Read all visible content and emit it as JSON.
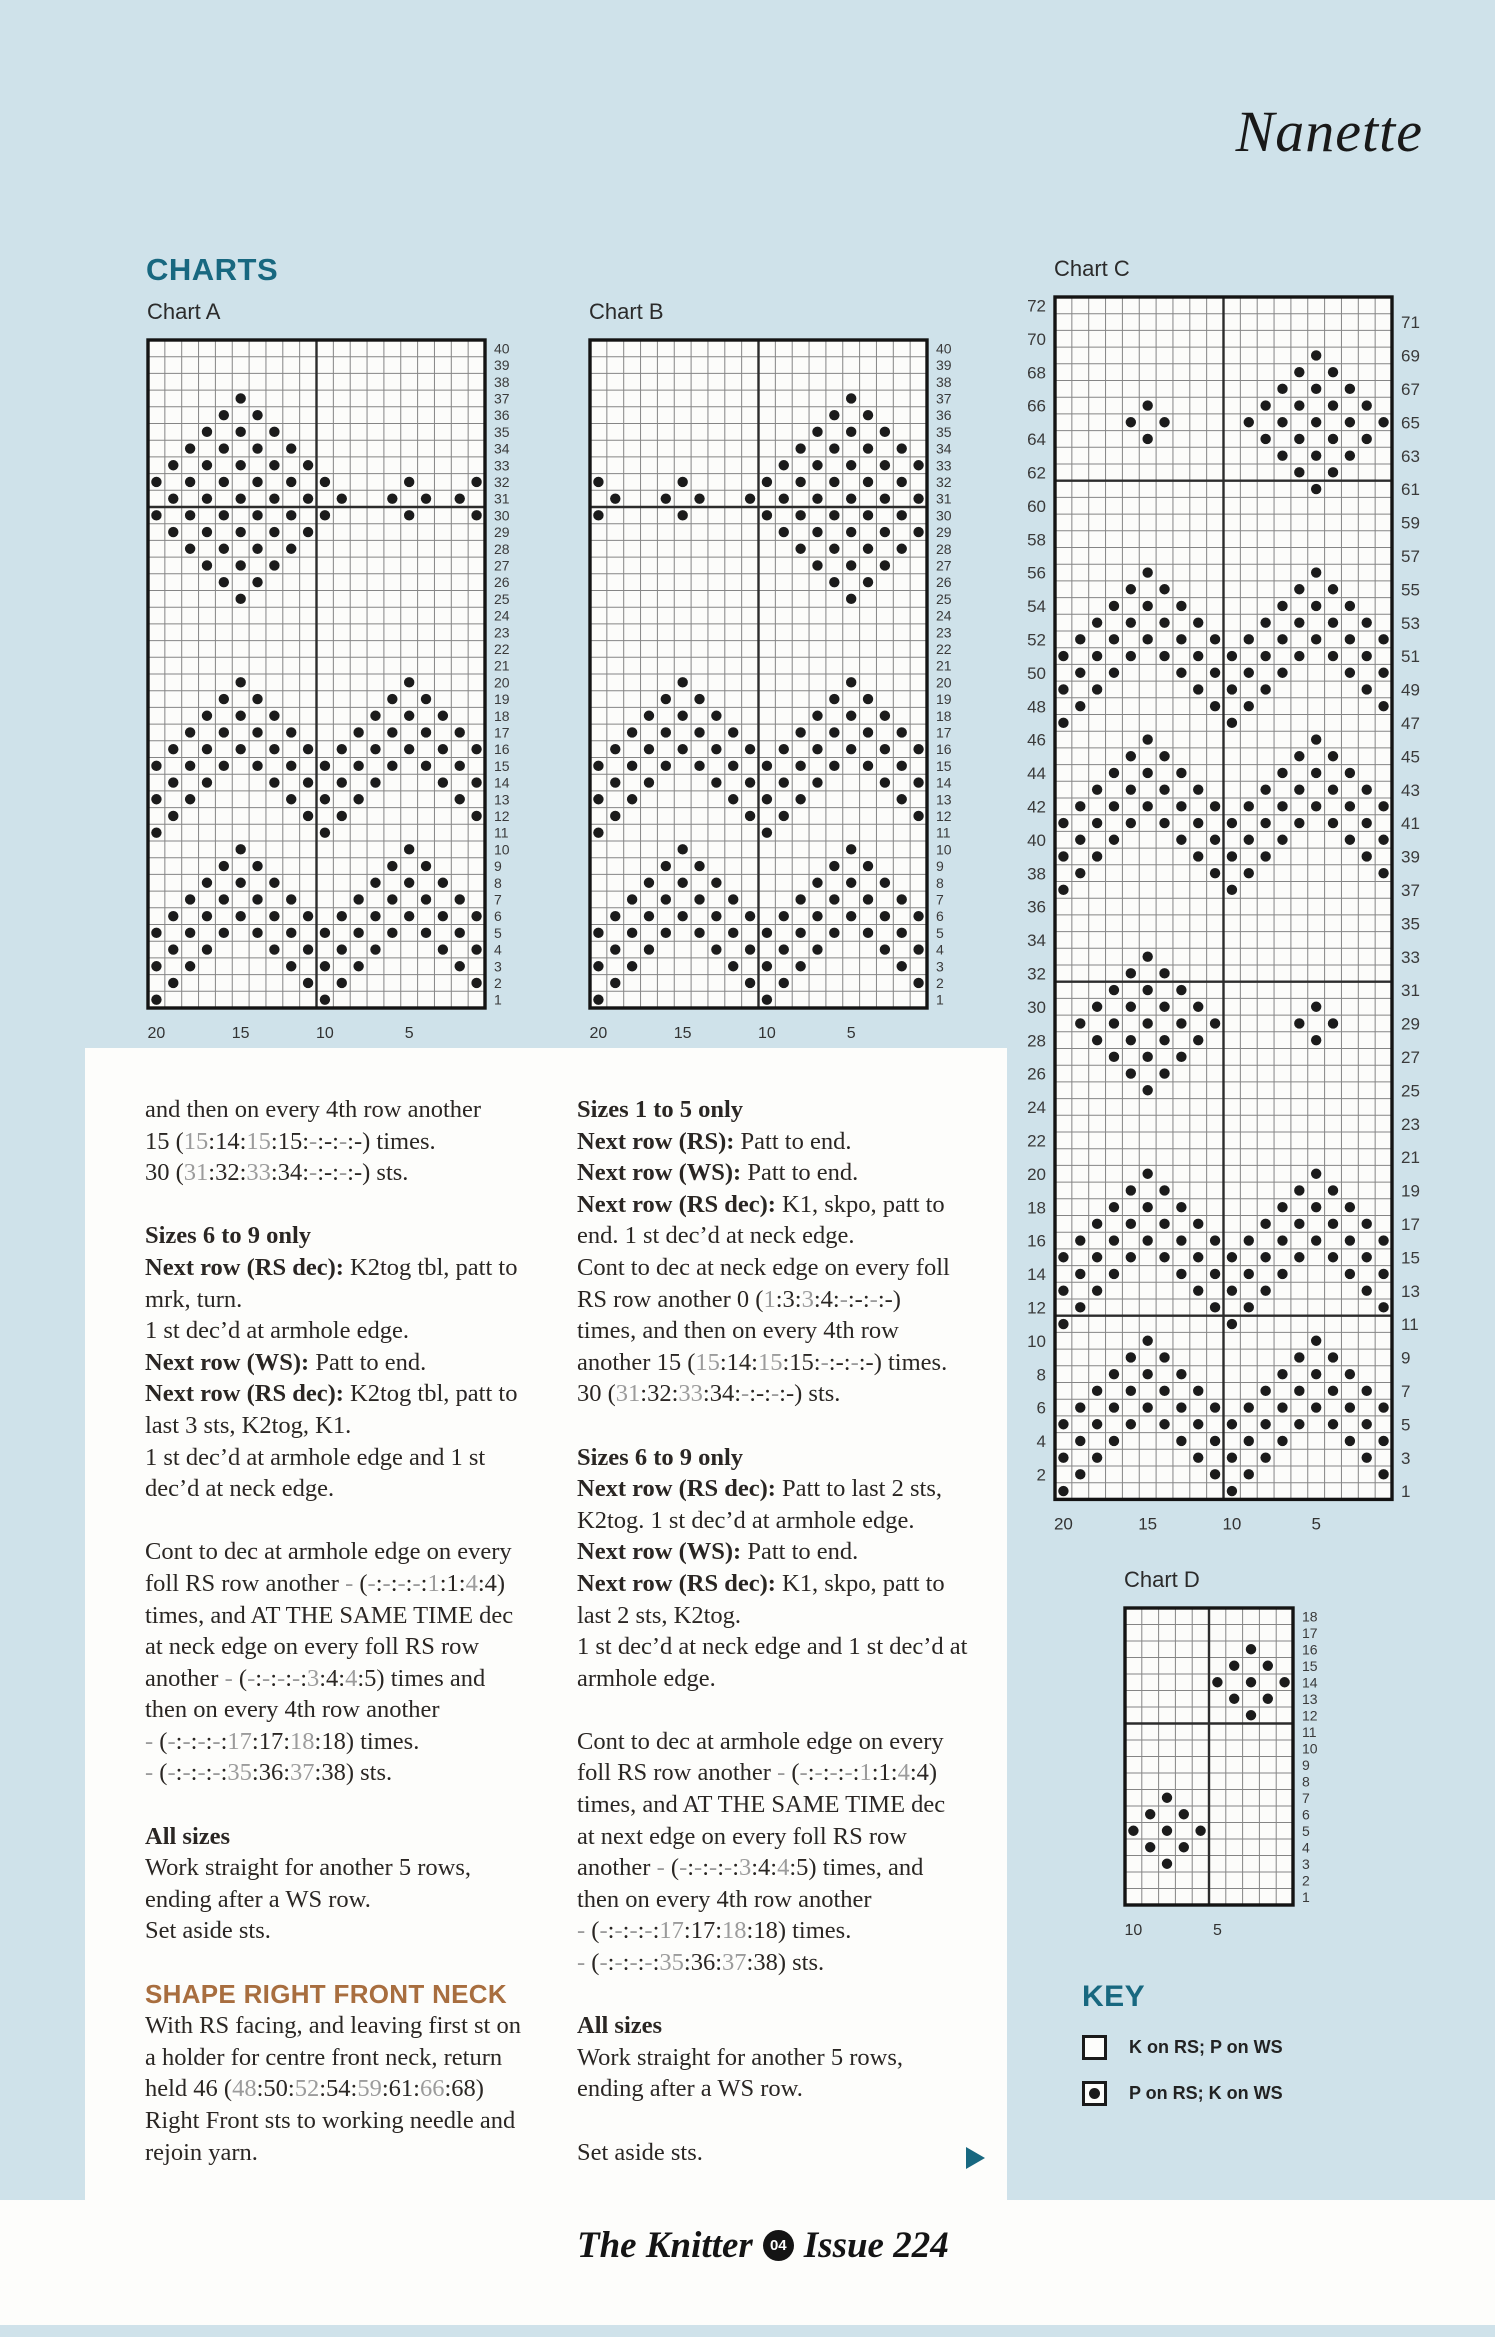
{
  "page": {
    "title": "Nanette",
    "background": "#cfe2ea",
    "accent_teal": "#186880",
    "accent_orange": "#a86e3f",
    "footer": {
      "magazine": "The Knitter",
      "badge": "04",
      "issue": "Issue 224"
    }
  },
  "charts_heading": "CHARTS",
  "key": {
    "heading": "KEY",
    "items": [
      {
        "symbol": "empty-square",
        "label": "K on RS; P on WS"
      },
      {
        "symbol": "dot-square",
        "label": "P on RS; K on WS"
      }
    ]
  },
  "charts": [
    {
      "id": "a",
      "label": "Chart A",
      "cols": 20,
      "rows": 40,
      "cw": 16.85,
      "ch": 16.7,
      "left": 148,
      "top": 340,
      "padl": 6,
      "row_label_mode": "right-all",
      "row_label_size": 14,
      "bottom_label_size": 16,
      "bottom_labels": [
        [
          "20",
          1
        ],
        [
          "15",
          6
        ],
        [
          "10",
          11
        ],
        [
          "5",
          16
        ]
      ],
      "bold_cols": [
        10
      ],
      "bold_rows": [
        10
      ],
      "grid": [
        "....................",
        "....................",
        "....................",
        ".....o..............",
        "....o.o.............",
        "...o.o.o............",
        "..o.o.o.o...........",
        ".o.o.o.o.o..........",
        "o.o.o.o.o.o....o...o",
        ".o.o.o.o.o.o..o.o.o.",
        "o.o.o.o.o.o....o...o",
        ".o.o.o.o.o..........",
        "..o.o.o.o...........",
        "...o.o.o............",
        "....o.o.............",
        ".....o..............",
        "....................",
        "....................",
        "....................",
        "....................",
        ".....o.........o....",
        "....o.o.......o.o...",
        "...o.o.o.....o.o.o..",
        "..o.o.o.o...o.o.o.o.",
        ".o.o.o.o.o.o.o.o.o.o",
        "o.o.o.o.o.o.o.o.o.o.",
        ".o.o...o.o.o.o...o.o",
        "o.o.....o.o.o.....o.",
        ".o.......o.o.......o",
        "o.........o.........",
        ".....o.........o....",
        "....o.o.......o.o...",
        "...o.o.o.....o.o.o..",
        "..o.o.o.o...o.o.o.o.",
        ".o.o.o.o.o.o.o.o.o.o",
        "o.o.o.o.o.o.o.o.o.o.",
        ".o.o...o.o.o.o...o.o",
        "o.o.....o.o.o.....o.",
        ".o.......o.o.......o",
        "o.........o........."
      ]
    },
    {
      "id": "b",
      "label": "Chart B",
      "cols": 20,
      "rows": 40,
      "cw": 16.85,
      "ch": 16.7,
      "left": 590,
      "top": 340,
      "padl": 6,
      "row_label_mode": "right-all",
      "row_label_size": 14,
      "bottom_label_size": 16,
      "bottom_labels": [
        [
          "20",
          1
        ],
        [
          "15",
          6
        ],
        [
          "10",
          11
        ],
        [
          "5",
          16
        ]
      ],
      "bold_cols": [
        10
      ],
      "bold_rows": [
        10
      ],
      "grid": [
        "....................",
        "....................",
        "....................",
        "...............o....",
        "..............o.o...",
        ".............o.o.o..",
        "............o.o.o.o.",
        "...........o.o.o.o.o",
        "o....o....o.o.o.o.o.",
        ".o..o.o..o.o.o.o.o.o",
        "o....o....o.o.o.o.o.",
        "...........o.o.o.o.o",
        "............o.o.o.o.",
        ".............o.o.o..",
        "..............o.o...",
        "...............o....",
        "....................",
        "....................",
        "....................",
        "....................",
        ".....o.........o....",
        "....o.o.......o.o...",
        "...o.o.o.....o.o.o..",
        "..o.o.o.o...o.o.o.o.",
        ".o.o.o.o.o.o.o.o.o.o",
        "o.o.o.o.o.o.o.o.o.o.",
        ".o.o...o.o.o.o...o.o",
        "o.o.....o.o.o.....o.",
        ".o.......o.o.......o",
        "o.........o.........",
        ".....o.........o....",
        "....o.o.......o.o...",
        "...o.o.o.....o.o.o..",
        "..o.o.o.o...o.o.o.o.",
        ".o.o.o.o.o.o.o.o.o.o",
        "o.o.o.o.o.o.o.o.o.o.",
        ".o.o...o.o.o.o...o.o",
        "o.o.....o.o.o.....o.",
        ".o.......o.o.......o",
        "o.........o........."
      ]
    },
    {
      "id": "c",
      "label": "Chart C",
      "cols": 20,
      "rows": 72,
      "cw": 16.85,
      "ch": 16.7,
      "left": 1055,
      "top": 297,
      "padl": 38,
      "row_label_mode": "split",
      "row_label_size": 17,
      "bottom_label_size": 17,
      "bottom_labels": [
        [
          "20",
          1
        ],
        [
          "15",
          6
        ],
        [
          "10",
          11
        ],
        [
          "5",
          16
        ]
      ],
      "bold_cols": [
        10
      ],
      "bold_rows": [
        11,
        41,
        61
      ],
      "grid": [
        "....................",
        "....................",
        "....................",
        "...............o....",
        "..............o.o...",
        ".............o.o.o..",
        ".....o......o.o.o.o.",
        "....o.o....o.o.o.o.o",
        ".....o......o.o.o.o.",
        ".............o.o.o..",
        "..............o.o...",
        "...............o....",
        "....................",
        "....................",
        "....................",
        "....................",
        ".....o.........o....",
        "....o.o.......o.o...",
        "...o.o.o.....o.o.o..",
        "..o.o.o.o...o.o.o.o.",
        ".o.o.o.o.o.o.o.o.o.o",
        "o.o.o.o.o.o.o.o.o.o.",
        ".o.o...o.o.o.o...o.o",
        "o.o.....o.o.o.....o.",
        ".o.......o.o.......o",
        "o.........o.........",
        ".....o.........o....",
        "....o.o.......o.o...",
        "...o.o.o.....o.o.o..",
        "..o.o.o.o...o.o.o.o.",
        ".o.o.o.o.o.o.o.o.o.o",
        "o.o.o.o.o.o.o.o.o.o.",
        ".o.o...o.o.o.o...o.o",
        "o.o.....o.o.o.....o.",
        ".o.......o.o.......o",
        "o.........o.........",
        "....................",
        "....................",
        "....................",
        ".....o..............",
        "....o.o.............",
        "...o.o.o............",
        "..o.o.o.o......o....",
        ".o.o.o.o.o....o.o...",
        "..o.o.o.o......o....",
        "...o.o.o............",
        "....o.o.............",
        ".....o..............",
        "....................",
        "....................",
        "....................",
        "....................",
        ".....o.........o....",
        "....o.o.......o.o...",
        "...o.o.o.....o.o.o..",
        "..o.o.o.o...o.o.o.o.",
        ".o.o.o.o.o.o.o.o.o.o",
        "o.o.o.o.o.o.o.o.o.o.",
        ".o.o...o.o.o.o...o.o",
        "o.o.....o.o.o.....o.",
        ".o.......o.o.......o",
        "o.........o.........",
        ".....o.........o....",
        "....o.o.......o.o...",
        "...o.o.o.....o.o.o..",
        "..o.o.o.o...o.o.o.o.",
        ".o.o.o.o.o.o.o.o.o.o",
        "o.o.o.o.o.o.o.o.o.o.",
        ".o.o...o.o.o.o...o.o",
        "o.o.....o.o.o.....o.",
        ".o.......o.o.......o",
        "o.........o........."
      ]
    },
    {
      "id": "d",
      "label": "Chart D",
      "cols": 10,
      "rows": 18,
      "cw": 16.8,
      "ch": 16.5,
      "left": 1125,
      "top": 1608,
      "padl": 6,
      "row_label_mode": "right-all",
      "row_label_size": 14,
      "bottom_label_size": 16,
      "bottom_labels": [
        [
          "10",
          1
        ],
        [
          "5",
          6
        ]
      ],
      "bold_cols": [
        5
      ],
      "bold_rows": [
        7
      ],
      "grid": [
        "..........",
        "..........",
        ".......o..",
        "......o.o.",
        ".....o.o.o",
        "......o.o.",
        ".......o..",
        "..........",
        "..........",
        "..........",
        "..........",
        "..o.......",
        ".o.o......",
        "o.o.o.....",
        ".o.o......",
        "..o.......",
        "..........",
        ".........."
      ]
    }
  ],
  "instructions": {
    "col1": [
      {
        "type": "p",
        "lines": [
          "and then on every 4th row another",
          "15 (~15~:14:~15~:15:~-~:-:~-~:-) times.",
          "30 (~31~:32:~33~:34:~-~:-:~-~:-) sts."
        ]
      },
      {
        "type": "p",
        "lines": [
          "*Sizes 6 to 9 only*",
          "*Next row (RS dec):* K2tog tbl, patt to",
          "mrk, turn.",
          "1 st dec’d at armhole edge.",
          "*Next row (WS):* Patt to end.",
          "*Next row (RS dec):* K2tog tbl, patt to",
          "last 3 sts, K2tog, K1.",
          "1 st dec’d at armhole edge and 1 st",
          "dec’d at neck edge."
        ]
      },
      {
        "type": "p",
        "lines": [
          "Cont to dec at armhole edge on every",
          "foll RS row another ~-~ (~-~:~-~:~-~:~-~:~1~:1:~4~:4)",
          "times, and AT THE SAME TIME dec",
          "at neck edge on every foll RS row",
          "another ~-~ (~-~:~-~:~-~:~-~:~3~:4:~4~:5) times and",
          "then on every 4th row another",
          "~-~ (~-~:~-~:~-~:~-~:~17~:17:~18~:18) times.",
          "~-~ (~-~:~-~:~-~:~-~:~35~:36:~37~:38) sts."
        ]
      },
      {
        "type": "p",
        "lines": [
          "*All sizes*",
          "Work straight for another 5 rows,",
          "ending after a WS row.",
          "Set aside sts."
        ]
      },
      {
        "type": "h-orange",
        "lines": [
          "SHAPE RIGHT FRONT NECK"
        ]
      },
      {
        "type": "p",
        "lines": [
          "With RS facing, and leaving first st on",
          "a holder for centre front neck, return",
          "held 46 (~48~:50:~52~:54:~59~:61:~66~:68)",
          "Right Front sts to working needle and",
          "rejoin yarn."
        ]
      }
    ],
    "col2": [
      {
        "type": "p",
        "lines": [
          "*Sizes 1 to 5 only*",
          "*Next row (RS):* Patt to end.",
          "*Next row (WS):* Patt to end.",
          "*Next row (RS dec):* K1, skpo, patt to",
          "end. 1 st dec’d at neck edge.",
          "Cont to dec at neck edge on every foll",
          "RS row another 0 (~1~:3:~3~:4:~-~:-:~-~:-)",
          "times, and then on every 4th row",
          "another 15 (~15~:14:~15~:15:~-~:-:~-~:-) times.",
          "30 (~31~:32:~33~:34:~-~:-:~-~:-) sts."
        ]
      },
      {
        "type": "p",
        "lines": [
          "*Sizes 6 to 9 only*",
          "*Next row (RS dec):* Patt to last 2 sts,",
          "K2tog. 1 st dec’d at armhole edge.",
          "*Next row (WS):* Patt to end.",
          "*Next row (RS dec):* K1, skpo, patt to",
          "last 2 sts, K2tog.",
          "1 st dec’d at neck edge and 1 st dec’d at",
          "armhole edge."
        ]
      },
      {
        "type": "p",
        "lines": [
          "Cont to dec at armhole edge on every",
          "foll RS row another ~-~ (~-~:~-~:~-~:~-~:~1~:1:~4~:4)",
          "times, and AT THE SAME TIME dec",
          "at next edge on every foll RS row",
          "another ~-~ (~-~:~-~:~-~:~-~:~3~:4:~4~:5) times, and",
          "then on every 4th row another",
          "~-~ (~-~:~-~:~-~:~-~:~17~:17:~18~:18) times.",
          "~-~ (~-~:~-~:~-~:~-~:~35~:36:~37~:38) sts."
        ]
      },
      {
        "type": "p",
        "lines": [
          "*All sizes*",
          "Work straight for another 5 rows,",
          "ending after a WS row."
        ]
      },
      {
        "type": "p",
        "lines": [
          "Set aside sts."
        ]
      }
    ]
  }
}
